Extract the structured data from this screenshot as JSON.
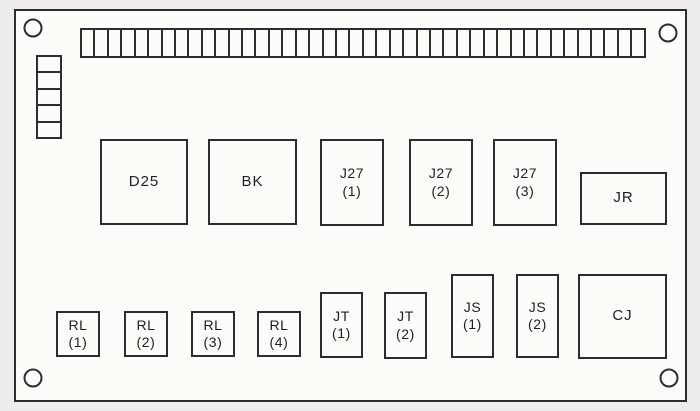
{
  "diagram": {
    "title": "electrical panel component layout",
    "colors": {
      "line": "#2d2d2d",
      "paper": "#eeedeb",
      "panel": "#fcfcf9",
      "ink": "#1f1f1f"
    },
    "panel": {
      "x": 14,
      "y": 9,
      "w": 673,
      "h": 393
    },
    "mounting_holes": [
      {
        "name": "mounting-hole-top-left",
        "cx": 33,
        "cy": 28
      },
      {
        "name": "mounting-hole-top-right",
        "cx": 668,
        "cy": 33
      },
      {
        "name": "mounting-hole-bottom-left",
        "cx": 33,
        "cy": 378
      },
      {
        "name": "mounting-hole-bottom-right",
        "cx": 669,
        "cy": 378
      }
    ],
    "terminal_strip": {
      "name": "terminal-strip",
      "segments": 42,
      "x": 80,
      "y": 28,
      "w": 566,
      "h": 30
    },
    "side_connector": {
      "name": "side-connector-block",
      "segments": 5,
      "x": 36,
      "y": 55,
      "w": 26,
      "h": 84
    },
    "components": [
      {
        "id": "d25",
        "label": "D25",
        "sub": "",
        "x": 100,
        "y": 139,
        "w": 88,
        "h": 86
      },
      {
        "id": "bk",
        "label": "BK",
        "sub": "",
        "x": 208,
        "y": 139,
        "w": 89,
        "h": 86
      },
      {
        "id": "j27-1",
        "label": "J27",
        "sub": "(1)",
        "x": 320,
        "y": 139,
        "w": 64,
        "h": 87
      },
      {
        "id": "j27-2",
        "label": "J27",
        "sub": "(2)",
        "x": 409,
        "y": 139,
        "w": 64,
        "h": 87
      },
      {
        "id": "j27-3",
        "label": "J27",
        "sub": "(3)",
        "x": 493,
        "y": 139,
        "w": 64,
        "h": 87
      },
      {
        "id": "jr",
        "label": "JR",
        "sub": "",
        "x": 580,
        "y": 172,
        "w": 87,
        "h": 53
      },
      {
        "id": "rl-1",
        "label": "RL",
        "sub": "(1)",
        "x": 56,
        "y": 311,
        "w": 44,
        "h": 46
      },
      {
        "id": "rl-2",
        "label": "RL",
        "sub": "(2)",
        "x": 124,
        "y": 311,
        "w": 44,
        "h": 46
      },
      {
        "id": "rl-3",
        "label": "RL",
        "sub": "(3)",
        "x": 191,
        "y": 311,
        "w": 44,
        "h": 46
      },
      {
        "id": "rl-4",
        "label": "RL",
        "sub": "(4)",
        "x": 257,
        "y": 311,
        "w": 44,
        "h": 46
      },
      {
        "id": "jt-1",
        "label": "JT",
        "sub": "(1)",
        "x": 320,
        "y": 292,
        "w": 43,
        "h": 66
      },
      {
        "id": "jt-2",
        "label": "JT",
        "sub": "(2)",
        "x": 384,
        "y": 292,
        "w": 43,
        "h": 67
      },
      {
        "id": "js-1",
        "label": "JS",
        "sub": "(1)",
        "x": 451,
        "y": 274,
        "w": 43,
        "h": 84
      },
      {
        "id": "js-2",
        "label": "JS",
        "sub": "(2)",
        "x": 516,
        "y": 274,
        "w": 43,
        "h": 84
      },
      {
        "id": "cj",
        "label": "CJ",
        "sub": "",
        "x": 578,
        "y": 274,
        "w": 89,
        "h": 85
      }
    ]
  }
}
